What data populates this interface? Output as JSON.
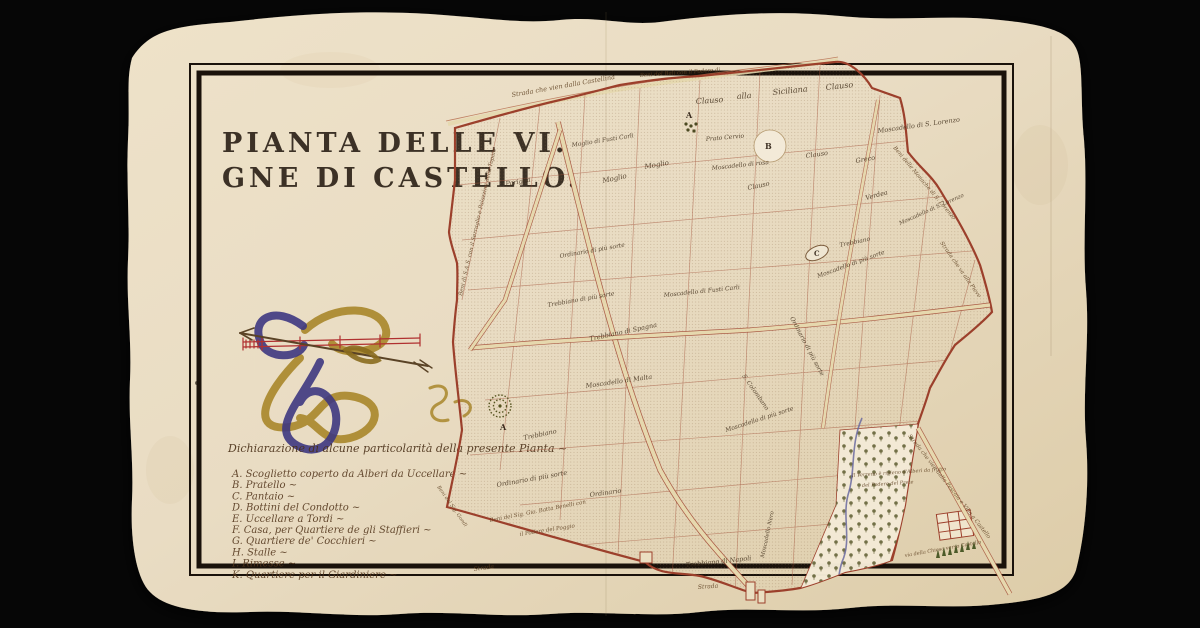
{
  "title": {
    "line1": "PIANTA DELLE VI.",
    "line2": "GNE DI CASTELLO."
  },
  "legend": {
    "header": "Dichiarazione di alcune particolarità della presente Pianta ~",
    "items": [
      "A.  Scoglietto coperto da Alberi da Uccellare ~",
      "B.  Pratello ~",
      "C.  Pantaio ~",
      "D.  Bottini del Condotto ~",
      "E.  Uccellare a Tordi ~",
      "F.  Casa, per Quartiere de gli Staffieri ~",
      "G.  Quartiere de' Cocchieri ~",
      "H.  Stalle ~",
      "I.  Rimesse ~",
      "K.  Quartiere per il Giardiniere ~"
    ]
  },
  "palette": {
    "background": "#060606",
    "paper": "#e9dcc3",
    "ink": "#2b2118",
    "boundary_red": "#9c3f2b",
    "road_beige": "#e6d8ae",
    "ribbon_blue": "#3e3781",
    "ribbon_gold": "#a8862a",
    "scale_red": "#b03030",
    "tree_green": "#5c5a2e",
    "stream_blue": "#6a6aa0"
  },
  "map": {
    "labels": [
      {
        "t": "Clauso",
        "x": 696,
        "y": 104,
        "r": -4,
        "s": 8
      },
      {
        "t": "alla",
        "x": 737,
        "y": 99,
        "r": -4,
        "s": 8
      },
      {
        "t": "Siciliana",
        "x": 773,
        "y": 95,
        "r": -6,
        "s": 8
      },
      {
        "t": "Clauso",
        "x": 826,
        "y": 90,
        "r": -6,
        "s": 8
      },
      {
        "t": "Moscadello di S. Lorenzo",
        "x": 878,
        "y": 133,
        "r": -8,
        "s": 6.5
      },
      {
        "t": "Moscadello di S. Lorenzo",
        "x": 900,
        "y": 225,
        "r": -24,
        "s": 5.5
      },
      {
        "t": "Prato Cervio",
        "x": 706,
        "y": 141,
        "r": -5,
        "s": 6
      },
      {
        "t": "Moscadello di rosa",
        "x": 712,
        "y": 170,
        "r": -6,
        "s": 6
      },
      {
        "t": "Clauso",
        "x": 748,
        "y": 190,
        "r": -12,
        "s": 6.5
      },
      {
        "t": "Clauso",
        "x": 806,
        "y": 158,
        "r": -8,
        "s": 6.5
      },
      {
        "t": "Greco",
        "x": 856,
        "y": 163,
        "r": -10,
        "s": 6.5
      },
      {
        "t": "Verdea",
        "x": 866,
        "y": 200,
        "r": -15,
        "s": 6.5
      },
      {
        "t": "Moglio di Fusti Carli",
        "x": 572,
        "y": 147,
        "r": -9,
        "s": 6
      },
      {
        "t": "Pariglia",
        "x": 506,
        "y": 186,
        "r": -10,
        "s": 6.5
      },
      {
        "t": "Moglio",
        "x": 603,
        "y": 183,
        "r": -12,
        "s": 7
      },
      {
        "t": "Moglio",
        "x": 645,
        "y": 169,
        "r": -10,
        "s": 7
      },
      {
        "t": "Trebbiano",
        "x": 840,
        "y": 247,
        "r": -12,
        "s": 6
      },
      {
        "t": "Trebbiano di Spagna",
        "x": 590,
        "y": 341,
        "r": -12,
        "s": 6.5
      },
      {
        "t": "Moscadello di Fusti Carli",
        "x": 664,
        "y": 297,
        "r": -6,
        "s": 6
      },
      {
        "t": "Moscadello di Malta",
        "x": 586,
        "y": 388,
        "r": -8,
        "s": 6.5
      },
      {
        "t": "Trebbiano di più sorte",
        "x": 548,
        "y": 307,
        "r": -10,
        "s": 6
      },
      {
        "t": "Ordinario di più sorte",
        "x": 497,
        "y": 487,
        "r": -10,
        "s": 6.5
      },
      {
        "t": "Ordinario",
        "x": 590,
        "y": 497,
        "r": -8,
        "s": 6.5
      },
      {
        "t": "Ordinario di più sorte",
        "x": 790,
        "y": 318,
        "r": 62,
        "s": 6
      },
      {
        "t": "Moscadello di più sorte",
        "x": 726,
        "y": 432,
        "r": -18,
        "s": 6
      },
      {
        "t": "S. Colombano",
        "x": 742,
        "y": 376,
        "r": 55,
        "s": 6
      },
      {
        "t": "Trebbiano di Napoli",
        "x": 686,
        "y": 567,
        "r": -6,
        "s": 6.5
      },
      {
        "t": "Moscadello Nero",
        "x": 764,
        "y": 558,
        "r": -78,
        "s": 5.5
      },
      {
        "t": "Trebbiano",
        "x": 524,
        "y": 440,
        "r": -12,
        "s": 6.5
      },
      {
        "t": "Ordinario di più sorte",
        "x": 560,
        "y": 258,
        "r": -10,
        "s": 6
      },
      {
        "t": "Moscadello di più sorte",
        "x": 818,
        "y": 278,
        "r": -20,
        "s": 6
      },
      {
        "t": "A",
        "x": 686,
        "y": 118,
        "r": 0,
        "s": 8,
        "c": "marker",
        "n": "marker-A-top"
      },
      {
        "t": "A",
        "x": 500,
        "y": 430,
        "r": 0,
        "s": 8,
        "c": "marker",
        "n": "marker-A"
      },
      {
        "t": "B",
        "x": 765,
        "y": 149,
        "r": 0,
        "s": 8,
        "c": "marker",
        "n": "marker-B"
      },
      {
        "t": "C",
        "x": 814,
        "y": 256,
        "r": 0,
        "s": 7,
        "c": "marker",
        "n": "marker-C"
      },
      {
        "t": "Strada che vien dalla Castellina",
        "x": 512,
        "y": 97,
        "r": -10,
        "s": 6.5,
        "c": "edge",
        "n": "road-label"
      },
      {
        "t": "Beni del Balì con il Podere di",
        "x": 640,
        "y": 77,
        "r": -4,
        "s": 5.5,
        "c": "edge",
        "n": "border-label"
      },
      {
        "t": "Beni di S.A.S. con il Serraglio e Palazzina della Topaia",
        "x": 462,
        "y": 296,
        "r": -77,
        "s": 5.5,
        "c": "edge",
        "n": "border-label"
      },
      {
        "t": "Beni delle Monache di S. Lorenzo",
        "x": 893,
        "y": 148,
        "r": 50,
        "s": 5.5,
        "c": "edge",
        "n": "border-label"
      },
      {
        "t": "Strada che va alla Pieve",
        "x": 940,
        "y": 243,
        "r": 55,
        "s": 5.5,
        "c": "edge",
        "n": "road-label"
      },
      {
        "t": "Beni del Sig. Gio. Batta Benelli con",
        "x": 490,
        "y": 522,
        "r": -11,
        "s": 5.5,
        "c": "edge",
        "n": "border-label"
      },
      {
        "t": "il Podere del Poggio",
        "x": 520,
        "y": 536,
        "r": -9,
        "s": 5.5,
        "c": "edge",
        "n": "border-label"
      },
      {
        "t": "Beni del Sig. Gondi",
        "x": 437,
        "y": 487,
        "r": 55,
        "s": 5,
        "c": "edge",
        "n": "border-label"
      },
      {
        "t": "Strada",
        "x": 474,
        "y": 571,
        "r": -8,
        "s": 6,
        "c": "edge",
        "n": "road-label"
      },
      {
        "t": "Strada",
        "x": 698,
        "y": 589,
        "r": -4,
        "s": 6,
        "c": "edge",
        "n": "road-label"
      },
      {
        "t": "Strada che vien dalla Pescaia e Villa a Castello",
        "x": 908,
        "y": 436,
        "r": 52,
        "s": 5.5,
        "c": "edge",
        "n": "road-label"
      },
      {
        "t": "via della Chiesa verso Castello",
        "x": 905,
        "y": 557,
        "r": -10,
        "s": 5,
        "c": "edge",
        "n": "road-label"
      },
      {
        "t": "Il Terreno è ripieno d'Alberi da frutto",
        "x": 852,
        "y": 477,
        "r": -4,
        "s": 5,
        "c": "edge",
        "n": "orchard-note"
      },
      {
        "t": "del Podere del Prete",
        "x": 862,
        "y": 487,
        "r": -4,
        "s": 5,
        "c": "edge",
        "n": "orchard-note"
      }
    ]
  }
}
